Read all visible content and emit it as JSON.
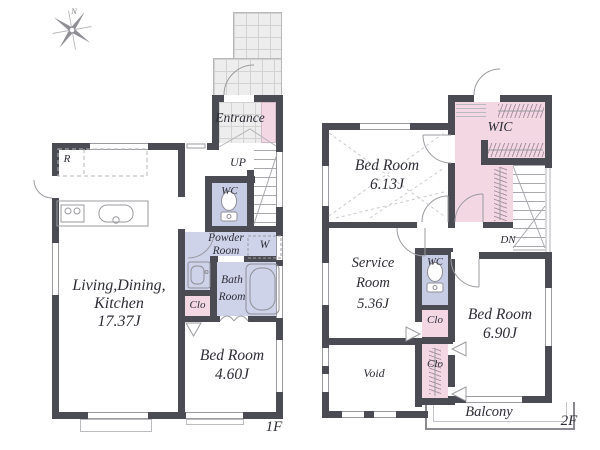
{
  "palette": {
    "wall_color": "#4b4b54",
    "closet_pink": "#f3d7e3",
    "wc_periwinkle": "#c7cce5",
    "bath_lavender": "#cfd3ea",
    "tile_gray": "#ededed",
    "line_gray": "#9b9ba1"
  },
  "compass": {
    "north_label": "N"
  },
  "floor1": {
    "floor_label": "1F",
    "entrance_label": "Entrance",
    "stairs_label": "UP",
    "wc_label": "WC",
    "powder_line1": "Powder",
    "powder_line2": "Room",
    "washer_label": "W",
    "bath_line1": "Bath",
    "bath_line2": "Room",
    "closet_label": "Clo",
    "fridge_label": "R",
    "ldk_line1": "Living,Dining,",
    "ldk_line2": "Kitchen",
    "ldk_size": "17.37J",
    "bedroom_name": "Bed Room",
    "bedroom_size": "4.60J"
  },
  "floor2": {
    "floor_label": "2F",
    "bedroom1_name": "Bed Room",
    "bedroom1_size": "6.13J",
    "wic_label": "WIC",
    "stairs_label": "DN",
    "service_line1": "Service",
    "service_line2": "Room",
    "service_size": "5.36J",
    "wc_label": "WC",
    "closet_upper_label": "Clo",
    "closet_lower_label": "Clo",
    "bedroom2_name": "Bed Room",
    "bedroom2_size": "6.90J",
    "void_label": "Void",
    "balcony_label": "Balcony"
  }
}
